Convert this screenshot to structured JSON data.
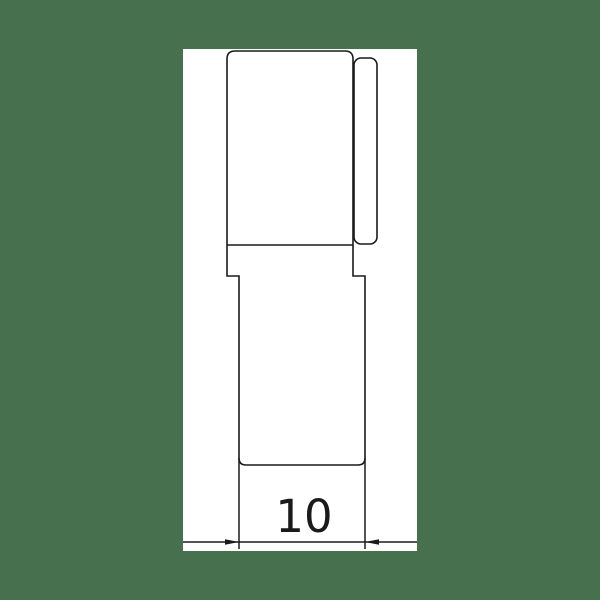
{
  "drawing": {
    "type": "technical-drawing",
    "part": {
      "description": "stepped cylindrical part profile with side tab, front view"
    },
    "dimension": {
      "value": "10"
    },
    "colors": {
      "background": "#47714e",
      "paper": "#ffffff",
      "line": "#1a1a1a"
    }
  }
}
